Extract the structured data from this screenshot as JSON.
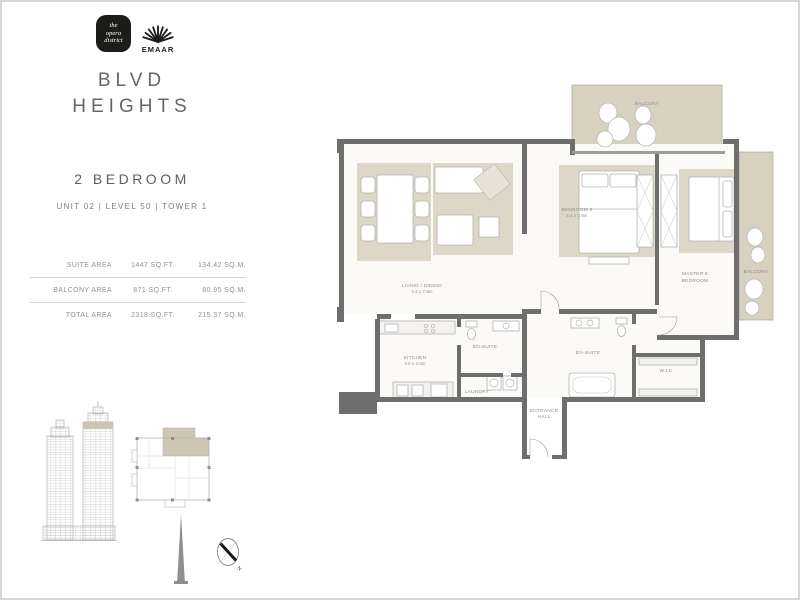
{
  "colors": {
    "wall": "#6e6e6e",
    "beige": "#d7d1c0",
    "rug": "#ddd7c7",
    "floor": "#fbfaf7",
    "label": "#8c8c8c",
    "title_text": "#63666a"
  },
  "header": {
    "opera_logo": [
      "the",
      "opera",
      "district"
    ],
    "emaar_label": "EMAAR",
    "title_line1": "BLVD",
    "title_line2": "HEIGHTS"
  },
  "unit": {
    "type": "2 BEDROOM",
    "info": "UNIT 02 | LEVEL 50 | TOWER 1"
  },
  "area_table": {
    "rows": [
      {
        "label": "SUITE AREA",
        "sqft": "1447 SQ.FT.",
        "sqm": "134.42 SQ.M."
      },
      {
        "label": "BALCONY AREA",
        "sqft": "871 SQ.FT.",
        "sqm": "80.95 SQ.M."
      },
      {
        "label": "TOTAL AREA",
        "sqft": "2318 SQ.FT.",
        "sqm": "215.37 SQ.M."
      }
    ]
  },
  "plan": {
    "labels": {
      "balcony_top": "BALCONY",
      "balcony_right": "BALCONY",
      "bedroom2": "BEDROOM 2",
      "bedroom2_dims": "5.4 x 3.9m",
      "living": "LIVING / DINING",
      "living_dims": "4.2 x 7.8m",
      "kitchen": "KITCHEN",
      "kitchen_dims": "4.0 x 3.0m",
      "ensuite_1": "EN-SUITE",
      "laundry": "LAUNDRY",
      "ensuite_2": "EN-SUITE",
      "wic": "W.I.C",
      "entrance_1": "ENTRANCE",
      "entrance_2": "HALL",
      "master_1": "MASTER'S",
      "master_2": "BEDROOM"
    }
  },
  "compass": {
    "north": "N"
  }
}
